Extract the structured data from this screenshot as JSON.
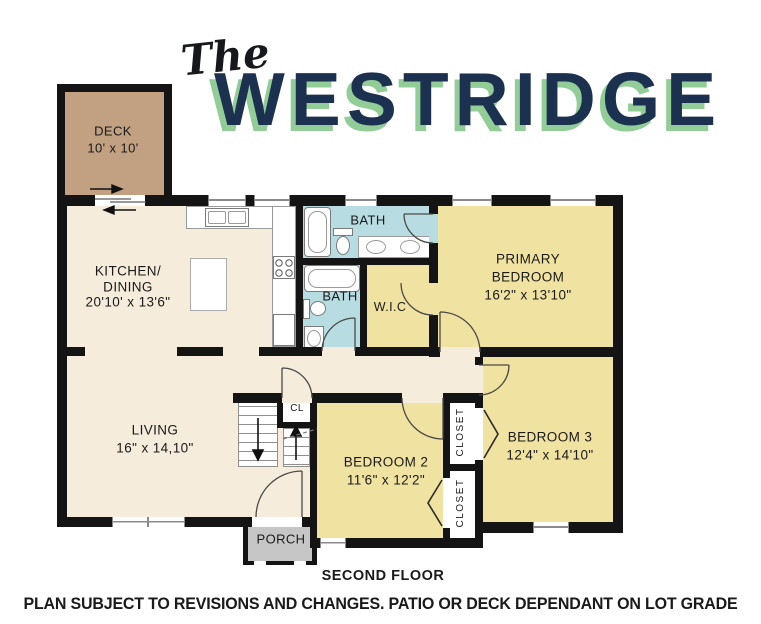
{
  "title": {
    "the": "The",
    "name": "WESTRIDGE"
  },
  "labels": {
    "deck": {
      "name": "DECK",
      "dims": "10' x 10'"
    },
    "kitchen": {
      "l1": "KITCHEN/",
      "l2": "DINING",
      "dims": "20'10' x 13'6\""
    },
    "bath_upper": {
      "name": "BATH"
    },
    "bath_lower": {
      "name": "BATH"
    },
    "wic": {
      "name": "W.I.C"
    },
    "primary": {
      "l1": "PRIMARY",
      "l2": "BEDROOM",
      "dims": "16'2\" x 13'10\""
    },
    "living": {
      "name": "LIVING",
      "dims": "16\" x 14,10\""
    },
    "bedroom2": {
      "name": "BEDROOM 2",
      "dims": "11'6\" x 12'2\""
    },
    "bedroom3": {
      "name": "BEDROOM 3",
      "dims": "12'4\" x 14'10\""
    },
    "closet_bedroom3": {
      "name": "CLOSET"
    },
    "closet_bedroom2": {
      "name": "CLOSET"
    },
    "cl": {
      "name": "CL"
    },
    "porch": {
      "name": "PORCH"
    }
  },
  "footer": {
    "floor": "SECOND FLOOR",
    "disclaimer": "PLAN SUBJECT TO REVISIONS AND CHANGES. PATIO OR DECK DEPENDANT ON LOT GRADE"
  },
  "colors": {
    "wall": "#141414",
    "floor_cream": "#f5ecdb",
    "room_yellow": "#f0e2a0",
    "bath_blue": "#b7dce2",
    "deck_tan": "#c2a183",
    "porch_gray": "#c6c6c6",
    "title_navy": "#1c3150",
    "title_green": "#92cc96"
  }
}
